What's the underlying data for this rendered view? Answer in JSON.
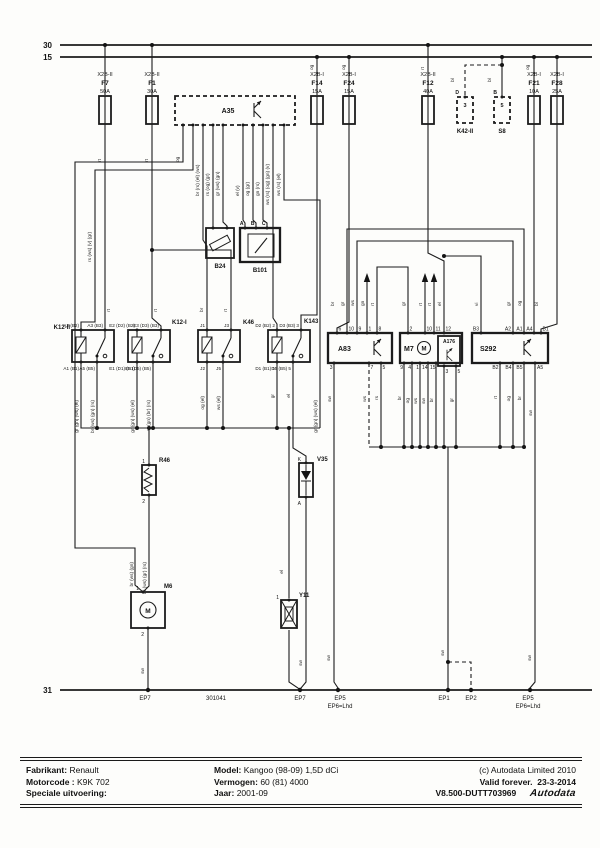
{
  "buses": {
    "b30": "30",
    "b15": "15",
    "b31": "31"
  },
  "fuses": [
    {
      "conn": "X2B-II",
      "id": "F7",
      "amp": "50A"
    },
    {
      "conn": "X2B-II",
      "id": "F1",
      "amp": "30A"
    },
    {
      "conn": "X2B-I",
      "id": "F14",
      "amp": "15A"
    },
    {
      "conn": "X2B-I",
      "id": "F24",
      "amp": "15A"
    },
    {
      "conn": "X2B-II",
      "id": "F12",
      "amp": "40A"
    },
    {
      "conn": "X2B-I",
      "id": "F21",
      "amp": "10A"
    },
    {
      "conn": "X2B-I",
      "id": "F28",
      "amp": "25A"
    }
  ],
  "boxes": {
    "a35": {
      "id": "A35"
    },
    "b24": {
      "id": "B24"
    },
    "b101": {
      "id": "B101",
      "pin_a": "A",
      "pin_b": "B",
      "pin_c": "C"
    },
    "k42": {
      "id": "K42-II",
      "pin": "3",
      "tag": "D"
    },
    "s8": {
      "id": "S8",
      "pin": "5",
      "tag": "B"
    },
    "k12ii": {
      "id": "K12-II",
      "t1": "A2 (B2)",
      "t2": "A3 (B3)",
      "b1": "A1 (B1)",
      "b2": "A5 (B5)"
    },
    "k12i": {
      "id": "K12-I",
      "t1": "E2 (D2) (B2)",
      "t2": "E3 (D3) (B3)",
      "b1": "E1 (D1) (B1)",
      "b2": "E5 (D5) (B5)"
    },
    "k46": {
      "id": "K46",
      "t1": "J1",
      "t2": "J3",
      "b1": "J2",
      "b2": "J5"
    },
    "k143": {
      "id": "K143",
      "t1": "D2 (B2) 2",
      "t2": "D3 (B3) 3",
      "b1": "D1 (B1) 1",
      "b2": "D5 (B5) 5"
    },
    "a83": {
      "id": "A83",
      "top": [
        "6",
        "10",
        "9",
        "1",
        "8"
      ],
      "bottom": [
        "3",
        "7",
        "5"
      ]
    },
    "m7": {
      "id": "M7",
      "motor": "M",
      "top": [
        "2",
        "10",
        "11",
        "12"
      ],
      "bottom": [
        "9",
        "4",
        "1",
        "14",
        "15"
      ]
    },
    "a176": {
      "id": "A176",
      "bottom": [
        "3",
        "5"
      ]
    },
    "s292": {
      "id": "S292",
      "top": [
        "B3",
        "A2",
        "A1",
        "A4",
        "B1"
      ],
      "bottom": [
        "B2",
        "B4",
        "B5",
        "A5"
      ]
    },
    "r46": {
      "id": "R46",
      "p1": "1",
      "p2": "2"
    },
    "m6": {
      "id": "M6",
      "p1": "1",
      "p2": "2",
      "motor": "M"
    },
    "v35": {
      "id": "V35",
      "p1": "K",
      "p2": "A"
    },
    "y11": {
      "id": "Y11",
      "p1": "1"
    }
  },
  "grounds": [
    {
      "id": "EP7",
      "sub": ""
    },
    {
      "id": "EP7",
      "sub": ""
    },
    {
      "id": "EP5",
      "sub": "EP6=Lhd"
    },
    {
      "id": "EP1",
      "sub": ""
    },
    {
      "id": "EP2",
      "sub": ""
    },
    {
      "id": "EP5",
      "sub": "EP6=Lhd"
    }
  ],
  "diagram_code": "301041",
  "wire_labels": [
    "rt",
    "rt",
    "og",
    "rs (ws) (v) (gr)",
    "br (rs) (el) (ws)",
    "rs (og) (gr)",
    "gr (ws) (gn)",
    "el (v)",
    "og (gr)",
    "gn (rs)",
    "ws (rs) (og) (gn) (v)",
    "ws (rs) (el)",
    "og",
    "og",
    "rt",
    "og",
    "bl",
    "bl",
    "rt",
    "rt",
    "br",
    "rt",
    "gr (gn) (ws) (el)",
    "br (ws) (gn) (rs)",
    "gr (gn) (ws) (el)",
    "vi (gn) (br) (rs)",
    "og (el)",
    "ws (el)",
    "gr",
    "el",
    "gr (gn) (ws) (el)",
    "el",
    "br (ws) (gn)",
    "br (ws) (gr) (rs)",
    "sw",
    "ws",
    "rs",
    "br",
    "og",
    "ws",
    "sw",
    "br",
    "gr",
    "rt",
    "og",
    "br",
    "sw",
    "br",
    "gr",
    "ws",
    "gn",
    "rt",
    "gr",
    "rt",
    "rt",
    "el",
    "vi",
    "gr",
    "og",
    "bl",
    "sw",
    "sw",
    "sw",
    "sw",
    "sw"
  ],
  "footer": {
    "fabrikant_label": "Fabrikant:",
    "fabrikant": "Renault",
    "motorcode_label": "Motorcode :",
    "motorcode": "K9K 702",
    "speciale_label": "Speciale uitvoering:",
    "model_label": "Model:",
    "model": "Kangoo (98-09) 1,5D dCi",
    "vermogen_label": "Vermogen:",
    "vermogen": "60 (81) 4000",
    "jaar_label": "Jaar:",
    "jaar": "2001-09",
    "copyright": "(c) Autodata Limited 2010",
    "valid_label": "Valid forever.",
    "valid_date": "23-3-2014",
    "version": "V8.500-DUTT703969",
    "logo": "Autodata"
  }
}
